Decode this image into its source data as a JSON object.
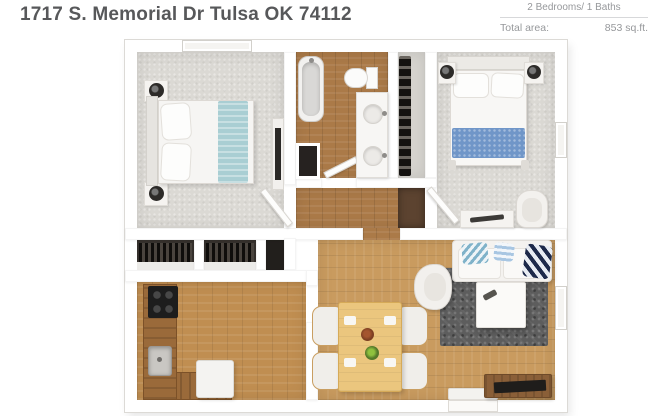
{
  "header": {
    "title": "1717 S. Memorial Dr Tulsa OK 74112"
  },
  "info_panel": {
    "beds_baths": "2 Bedrooms/ 1 Baths",
    "total_area_label": "Total area:",
    "total_area_value": "853 sq.ft."
  },
  "floorplan": {
    "type": "2d-top-down-render",
    "rooms_depicted": [
      "bedroom-1",
      "bathroom",
      "shoe-closet",
      "bedroom-2",
      "wardrobe-closets",
      "kitchen",
      "dining-area",
      "living-area",
      "hallway"
    ],
    "fixtures_depicted": [
      "double-bed",
      "nightstands",
      "bathtub",
      "toilet",
      "double-sink-vanity",
      "wardrobes",
      "stove",
      "kitchen-sink",
      "refrigerator",
      "dining-table-4-chairs",
      "sofa",
      "armchair",
      "coffee-table",
      "rug",
      "tv-console",
      "door-mat",
      "windows",
      "doors"
    ]
  },
  "colors": {
    "title_text": "#57585a",
    "info_text": "#96989b",
    "divider": "#d7d8da",
    "wall": "#ffffff",
    "carpet": "#dbd9d4",
    "hall_wood": "#ab7a48",
    "kitchen_wood": "#c08e51",
    "living_wood": "#c99b5f",
    "closet_dark": "#35302c",
    "closet_floor_brown": "#5c4330",
    "counter_wood": "#9a6a3a",
    "rug_gray": "#5d5d5d",
    "bed1_blanket_teal": "#a9ced3",
    "bed2_blanket_blue": "#7096c8",
    "dining_table": "#ebc67e"
  }
}
